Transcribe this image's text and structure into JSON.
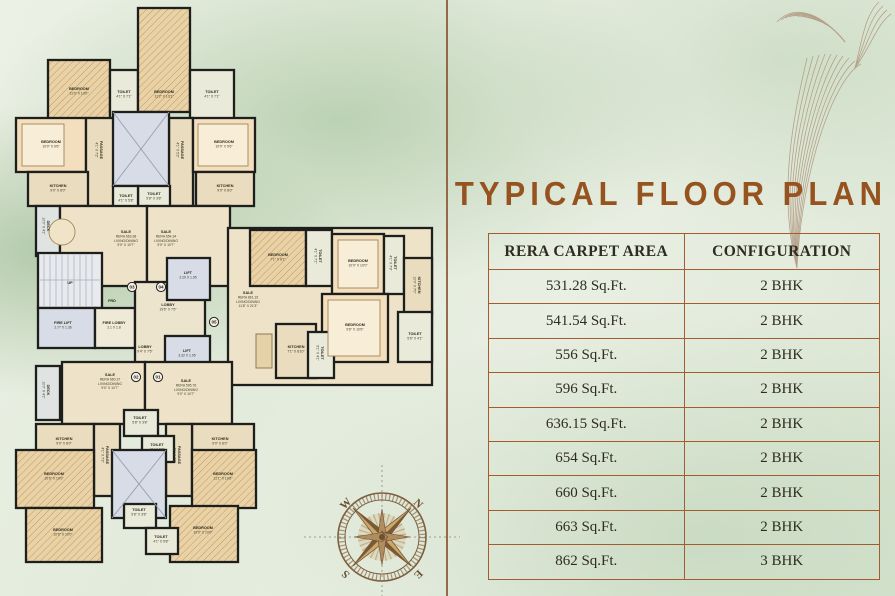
{
  "title": "TYPICAL FLOOR PLAN",
  "table": {
    "headers": [
      "RERA CARPET AREA",
      "CONFIGURATION"
    ],
    "rows": [
      [
        "531.28 Sq.Ft.",
        "2 BHK"
      ],
      [
        "541.54 Sq.Ft.",
        "2 BHK"
      ],
      [
        "556 Sq.Ft.",
        "2 BHK"
      ],
      [
        "596 Sq.Ft.",
        "2 BHK"
      ],
      [
        "636.15 Sq.Ft.",
        "2 BHK"
      ],
      [
        "654 Sq.Ft.",
        "2 BHK"
      ],
      [
        "660 Sq.Ft.",
        "2 BHK"
      ],
      [
        "663 Sq.Ft.",
        "2 BHK"
      ],
      [
        "862 Sq.Ft.",
        "3 BHK"
      ]
    ]
  },
  "compass": {
    "west": "W",
    "north": "N",
    "south": "S",
    "east": "E"
  },
  "colors": {
    "accent_title": "#96531f",
    "table_border": "#a35c2e",
    "wall": "#1e1e1c",
    "floor_beige": "#eee3c8",
    "bedroom_peach": "#f3dfbd",
    "shaft_blue": "#d7dce6",
    "background_green": "#e2ebdb"
  },
  "floor_plan": {
    "unit_badges": [
      {
        "num": "03",
        "x": 132,
        "y": 287
      },
      {
        "num": "04",
        "x": 161,
        "y": 287
      },
      {
        "num": "05",
        "x": 214,
        "y": 322
      },
      {
        "num": "02",
        "x": 136,
        "y": 377
      },
      {
        "num": "01",
        "x": 158,
        "y": 377
      }
    ],
    "labels": [
      {
        "x": 79,
        "y": 90,
        "lines": [
          "BEDROOM",
          "11'0\" X 13'0\""
        ]
      },
      {
        "x": 124,
        "y": 93,
        "lines": [
          "TOILET",
          "4'1\" X 7'1\""
        ]
      },
      {
        "x": 164,
        "y": 93,
        "lines": [
          "BEDROOM",
          "11'2\" X 13'1\""
        ]
      },
      {
        "x": 212,
        "y": 93,
        "lines": [
          "TOILET",
          "4'1\" X 7'1\""
        ]
      },
      {
        "x": 51,
        "y": 143,
        "lines": [
          "BEDROOM",
          "10'0\" X 9'6\""
        ]
      },
      {
        "x": 100,
        "y": 150,
        "rot": 90,
        "lines": [
          "PASSAGE",
          "4'1\" X 7'2\""
        ]
      },
      {
        "x": 181,
        "y": 150,
        "rot": 90,
        "lines": [
          "PASSAGE",
          "4'1\" X 5'2\""
        ]
      },
      {
        "x": 224,
        "y": 143,
        "lines": [
          "BEDROOM",
          "10'0\" X 9'6\""
        ]
      },
      {
        "x": 58,
        "y": 187,
        "lines": [
          "KITCHEN",
          "9'0\" X 8'0\""
        ]
      },
      {
        "x": 225,
        "y": 187,
        "lines": [
          "KITCHEN",
          "9'0\" X 8'0\""
        ]
      },
      {
        "x": 154,
        "y": 195,
        "lines": [
          "TOILET",
          "5'8\" X 3'8\""
        ]
      },
      {
        "x": 126,
        "y": 197,
        "lines": [
          "TOILET",
          "4'1\" X 5'8\""
        ]
      },
      {
        "x": 47,
        "y": 226,
        "rot": 90,
        "lines": [
          "DECK",
          "10'0\" X 4'1\""
        ]
      },
      {
        "x": 126,
        "y": 233,
        "lines": [
          "SALE",
          "RERA 663.38",
          "LIVING/DINING",
          "9'0\" X 10'7\""
        ]
      },
      {
        "x": 166,
        "y": 233,
        "lines": [
          "SALE",
          "RERA 654.34",
          "LIVING/DINING",
          "9'0\" X 10'7\""
        ]
      },
      {
        "x": 70,
        "y": 284,
        "lines": [
          "UP"
        ]
      },
      {
        "x": 63,
        "y": 324,
        "lines": [
          "FIRE LIFT",
          "2.77 X 1.36"
        ]
      },
      {
        "x": 114,
        "y": 324,
        "lines": [
          "FIRE LOBBY",
          "2.1 X 1.8"
        ]
      },
      {
        "x": 112,
        "y": 302,
        "lines": [
          "FRD"
        ]
      },
      {
        "x": 168,
        "y": 306,
        "lines": [
          "LOBBY",
          "19'6\" X 7'5\""
        ]
      },
      {
        "x": 188,
        "y": 274,
        "lines": [
          "LIFT",
          "2.29 X 1.95"
        ]
      },
      {
        "x": 145,
        "y": 348,
        "lines": [
          "LOBBY",
          "9'4\" X 7'5\""
        ]
      },
      {
        "x": 187,
        "y": 352,
        "lines": [
          "LIFT",
          "3.32 X 1.95"
        ]
      },
      {
        "x": 248,
        "y": 294,
        "lines": [
          "SALE",
          "RERA 861.32",
          "LIVING/DINING",
          "11'8\" X 21'3\""
        ]
      },
      {
        "x": 278,
        "y": 256,
        "lines": [
          "BEDROOM",
          "7'1\" X 8'1\""
        ]
      },
      {
        "x": 319,
        "y": 256,
        "rot": 90,
        "lines": [
          "TOILET",
          "4'1\" X 7'1\""
        ]
      },
      {
        "x": 358,
        "y": 262,
        "lines": [
          "BEDROOM",
          "10'0\" X 10'0\""
        ]
      },
      {
        "x": 394,
        "y": 263,
        "rot": 90,
        "lines": [
          "TOILET",
          "4'1\" X 7'3\""
        ]
      },
      {
        "x": 418,
        "y": 285,
        "rot": 90,
        "lines": [
          "KITCHEN",
          "10'0\" X 7'0\""
        ]
      },
      {
        "x": 355,
        "y": 326,
        "lines": [
          "BEDROOM",
          "9'6\" X 10'6\""
        ]
      },
      {
        "x": 415,
        "y": 335,
        "lines": [
          "TOILET",
          "5'6\" X 4'1\""
        ]
      },
      {
        "x": 296,
        "y": 348,
        "lines": [
          "KITCHEN",
          "7'1\" X 8'10\""
        ]
      },
      {
        "x": 321,
        "y": 353,
        "rot": 90,
        "lines": [
          "TOILET",
          "5'1\" X 4'1\""
        ]
      },
      {
        "x": 47,
        "y": 390,
        "rot": 90,
        "lines": [
          "DECK",
          "10'0\" X 4'1\""
        ]
      },
      {
        "x": 110,
        "y": 376,
        "lines": [
          "SALE",
          "RERA 660.37",
          "LIVING/DINING",
          "9'0\" X 10'7\""
        ]
      },
      {
        "x": 186,
        "y": 382,
        "lines": [
          "SALE",
          "RERA 595.76",
          "LIVING/DINING",
          "9'0\" X 10'7\""
        ]
      },
      {
        "x": 64,
        "y": 440,
        "lines": [
          "KITCHEN",
          "9'0\" X 8'0\""
        ]
      },
      {
        "x": 220,
        "y": 440,
        "lines": [
          "KITCHEN",
          "9'0\" X 8'0\""
        ]
      },
      {
        "x": 140,
        "y": 419,
        "lines": [
          "TOILET",
          "5'8\" X 3'8\""
        ]
      },
      {
        "x": 157,
        "y": 446,
        "lines": [
          "TOILET",
          "4'1\" X 5'8\""
        ]
      },
      {
        "x": 106,
        "y": 455,
        "rot": 90,
        "lines": [
          "PASSAGE",
          "4'1\" X 7'2\""
        ]
      },
      {
        "x": 178,
        "y": 455,
        "rot": 90,
        "lines": [
          "PASSAGE",
          "4'1\" X 7'2\""
        ]
      },
      {
        "x": 54,
        "y": 475,
        "lines": [
          "BEDROOM",
          "10'6\" X 10'0\""
        ]
      },
      {
        "x": 223,
        "y": 475,
        "lines": [
          "BEDROOM",
          "11'1\" X 10'6\""
        ]
      },
      {
        "x": 63,
        "y": 531,
        "lines": [
          "BEDROOM",
          "10'6\" X 10'0\""
        ]
      },
      {
        "x": 203,
        "y": 529,
        "lines": [
          "BEDROOM",
          "10'0\" X 10'0\""
        ]
      },
      {
        "x": 139,
        "y": 511,
        "lines": [
          "TOILET",
          "5'8\" X 3'8\""
        ]
      },
      {
        "x": 161,
        "y": 538,
        "lines": [
          "TOILET",
          "4'1\" X 5'8\""
        ]
      }
    ]
  }
}
